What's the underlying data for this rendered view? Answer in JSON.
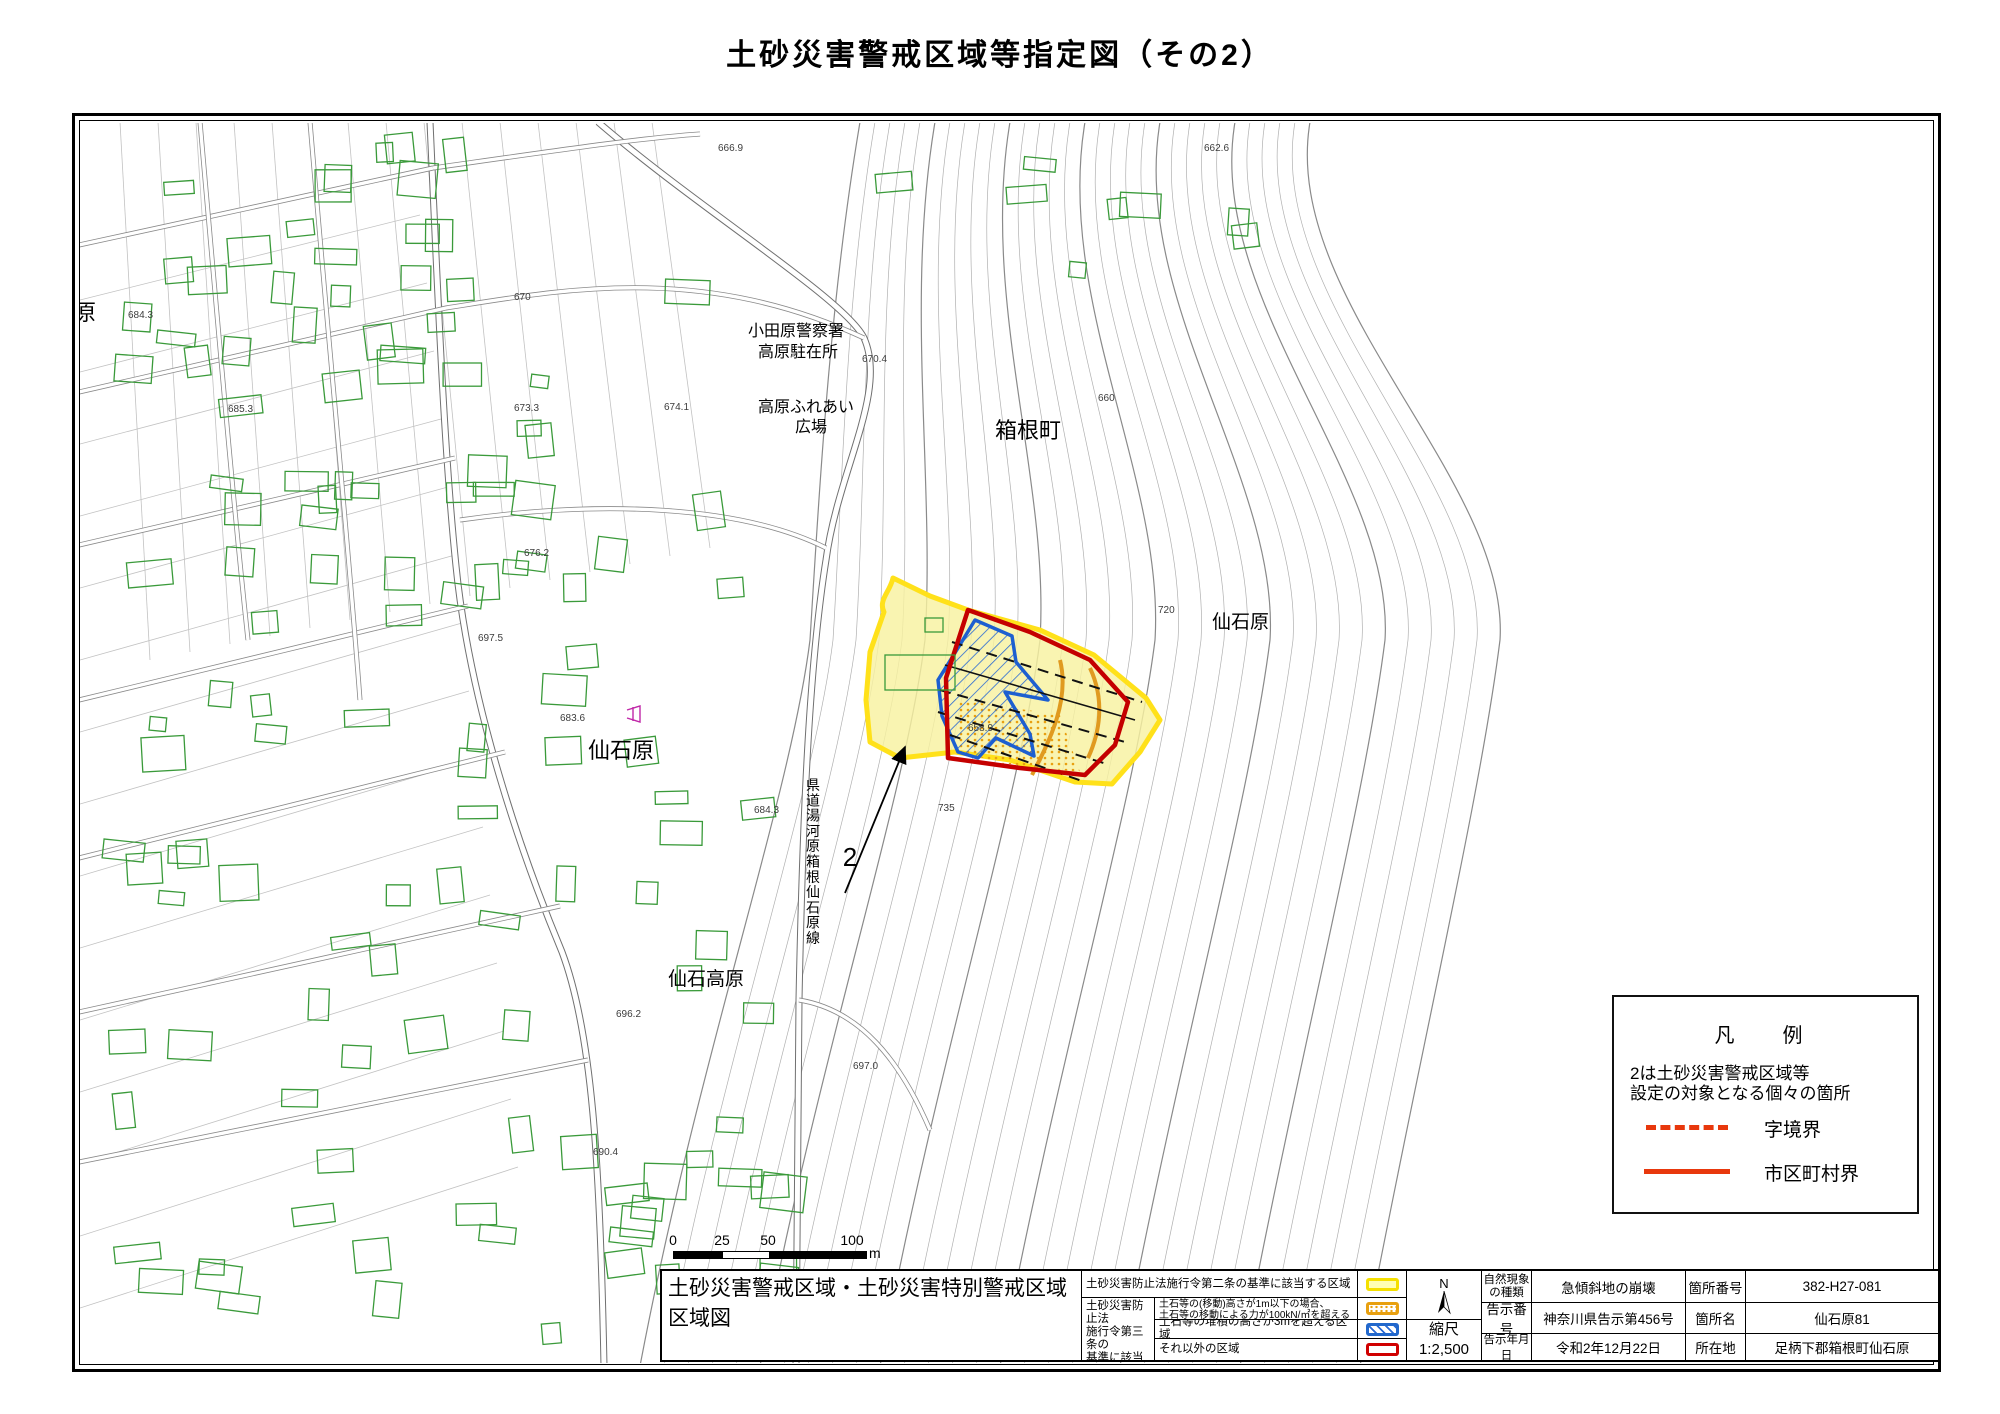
{
  "title": "土砂災害警戒区域等指定図（その2）",
  "map": {
    "area_labels": {
      "hakone": "箱根町",
      "sengokuhara_e": "仙石原",
      "sengokuhara_w": "仙石原",
      "sengoku_kogen": "仙石高原",
      "hara_partial": "原"
    },
    "poi": {
      "police_l1": "小田原警察署",
      "police_l2": "高原駐在所",
      "plaza_l1": "高原ふれあい",
      "plaza_l2": "広場",
      "route": "県道湯河原箱根仙石原線",
      "site_no": "2"
    },
    "spots": [
      {
        "v": "666.9"
      },
      {
        "v": "662.6"
      },
      {
        "v": "670"
      },
      {
        "v": "660"
      },
      {
        "v": "670.4"
      },
      {
        "v": "673.3"
      },
      {
        "v": "674.1"
      },
      {
        "v": "676.2"
      },
      {
        "v": "685.3"
      },
      {
        "v": "684.3"
      },
      {
        "v": "683.6"
      },
      {
        "v": "684.3"
      },
      {
        "v": "697.5"
      },
      {
        "v": "696.2"
      },
      {
        "v": "697.0"
      },
      {
        "v": "720"
      },
      {
        "v": "735"
      },
      {
        "v": "658.9"
      },
      {
        "v": "690.4"
      }
    ]
  },
  "legend_box": {
    "title": "凡　例",
    "note1": "2は土砂災害警戒区域等",
    "note2": "設定の対象となる個々の箇所",
    "dashed": "字境界",
    "solid": "市区町村界"
  },
  "scalebar": {
    "n0": "0",
    "n25": "25",
    "n50": "50",
    "n100": "100",
    "unit": "m"
  },
  "table": {
    "sheet_l1": "土砂災害警戒区域・土砂災害特別警戒区域",
    "sheet_l2": "区域図",
    "law2": "土砂災害防止法施行令第二条の基準に該当する区域",
    "law3_l1": "土砂災害防止法",
    "law3_l2": "施行令第三条の",
    "law3_l3": "基準に該当する",
    "law3_l4": "区域",
    "r2_l1": "土石等の(移動)高さが1m以下の場合、",
    "r2_l2": "土石等の移動による力が100kN/㎡を超える区域",
    "r3": "土石等の堆積の高さが3mを超える区域",
    "r4": "それ以外の区域",
    "north": "N",
    "scale_k": "縮尺",
    "scale_v": "1:2,500",
    "rows": [
      {
        "k1a": "自然現象",
        "k1b": "の種類",
        "v1": "急傾斜地の崩壊",
        "k2": "箇所番号",
        "v2": "382-H27-081"
      },
      {
        "k1a": "告示番号",
        "k1b": "",
        "v1": "神奈川県告示第456号",
        "k2": "箇所名",
        "v2": "仙石原81"
      },
      {
        "k1a": "告示年月日",
        "k1b": "",
        "v1": "令和2年12月22日",
        "k2": "所在地",
        "v2": "足柄下郡箱根町仙石原"
      }
    ]
  },
  "colors": {
    "warning_yellow": "#ffe11a",
    "special_red": "#c40000",
    "deposit_blue": "#1d5fd0",
    "flow_orange": "#e8a010",
    "legend_line": "#e8380d",
    "building_green": "#3a9a3a"
  }
}
